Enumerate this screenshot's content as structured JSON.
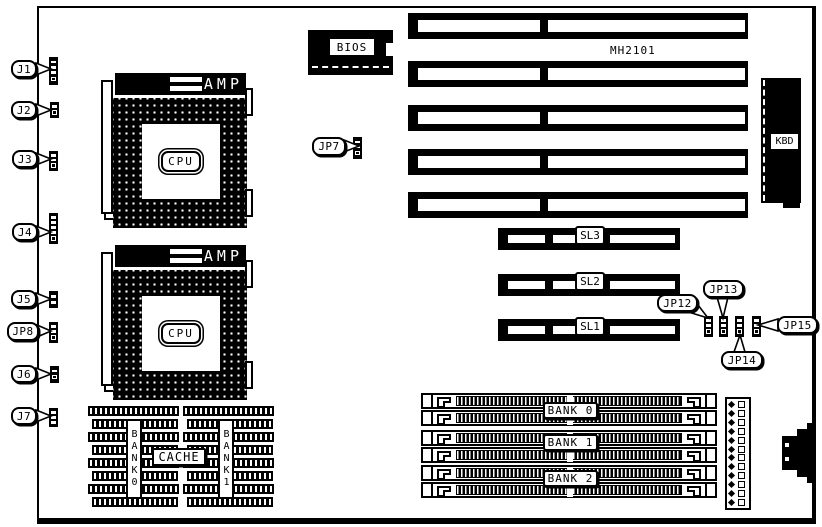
{
  "diagram": {
    "board_name": "MH2101",
    "colors": {
      "ink": "#000000",
      "paper": "#ffffff"
    },
    "left_connectors": [
      {
        "label": "J1",
        "pins": [
          "dash",
          "dash",
          "dash",
          "ring"
        ]
      },
      {
        "label": "J2",
        "pins": [
          "dash",
          "ring"
        ]
      },
      {
        "label": "J3",
        "pins": [
          "dash",
          "dash",
          "ring"
        ]
      },
      {
        "label": "J4",
        "pins": [
          "dash",
          "dash",
          "dash",
          "dash",
          "ring"
        ]
      },
      {
        "label": "J5",
        "pins": [
          "dash",
          "dash"
        ]
      },
      {
        "label": "JP8",
        "pins": [
          "dash",
          "dash",
          "ring"
        ]
      },
      {
        "label": "J6",
        "pins": [
          "dash",
          "ring"
        ]
      },
      {
        "label": "J7",
        "pins": [
          "dash",
          "dash",
          "dash"
        ]
      }
    ],
    "cpu_sockets": [
      {
        "brand": "AMP",
        "chip": "CPU"
      },
      {
        "brand": "AMP",
        "chip": "CPU"
      }
    ],
    "bios_label": "BIOS",
    "jp7": {
      "label": "JP7",
      "pins": [
        "dash",
        "dash",
        "ring"
      ]
    },
    "kbd_label": "KBD",
    "isa_slot_count": 5,
    "sl_slots": [
      "SL3",
      "SL2",
      "SL1"
    ],
    "right_jumpers": [
      {
        "label": "JP12",
        "pins": [
          "dash",
          "dash",
          "ring"
        ]
      },
      {
        "label": "JP13",
        "pins": [
          "dash",
          "dash",
          "ring"
        ]
      },
      {
        "label": "JP14",
        "pins": [
          "dash",
          "dash",
          "ring"
        ]
      },
      {
        "label": "JP15",
        "pins": [
          "dash",
          "dash",
          "ring"
        ]
      }
    ],
    "memory": {
      "simm_slot_count": 6,
      "bank_labels": [
        "BANK 0",
        "BANK 1",
        "BANK 2"
      ]
    },
    "power_connector": {
      "pin_rows": 12
    },
    "cache": {
      "label": "CACHE",
      "bank0_label": "BANK0",
      "bank1_label": "BANK1",
      "rows_per_bank": 8
    }
  }
}
